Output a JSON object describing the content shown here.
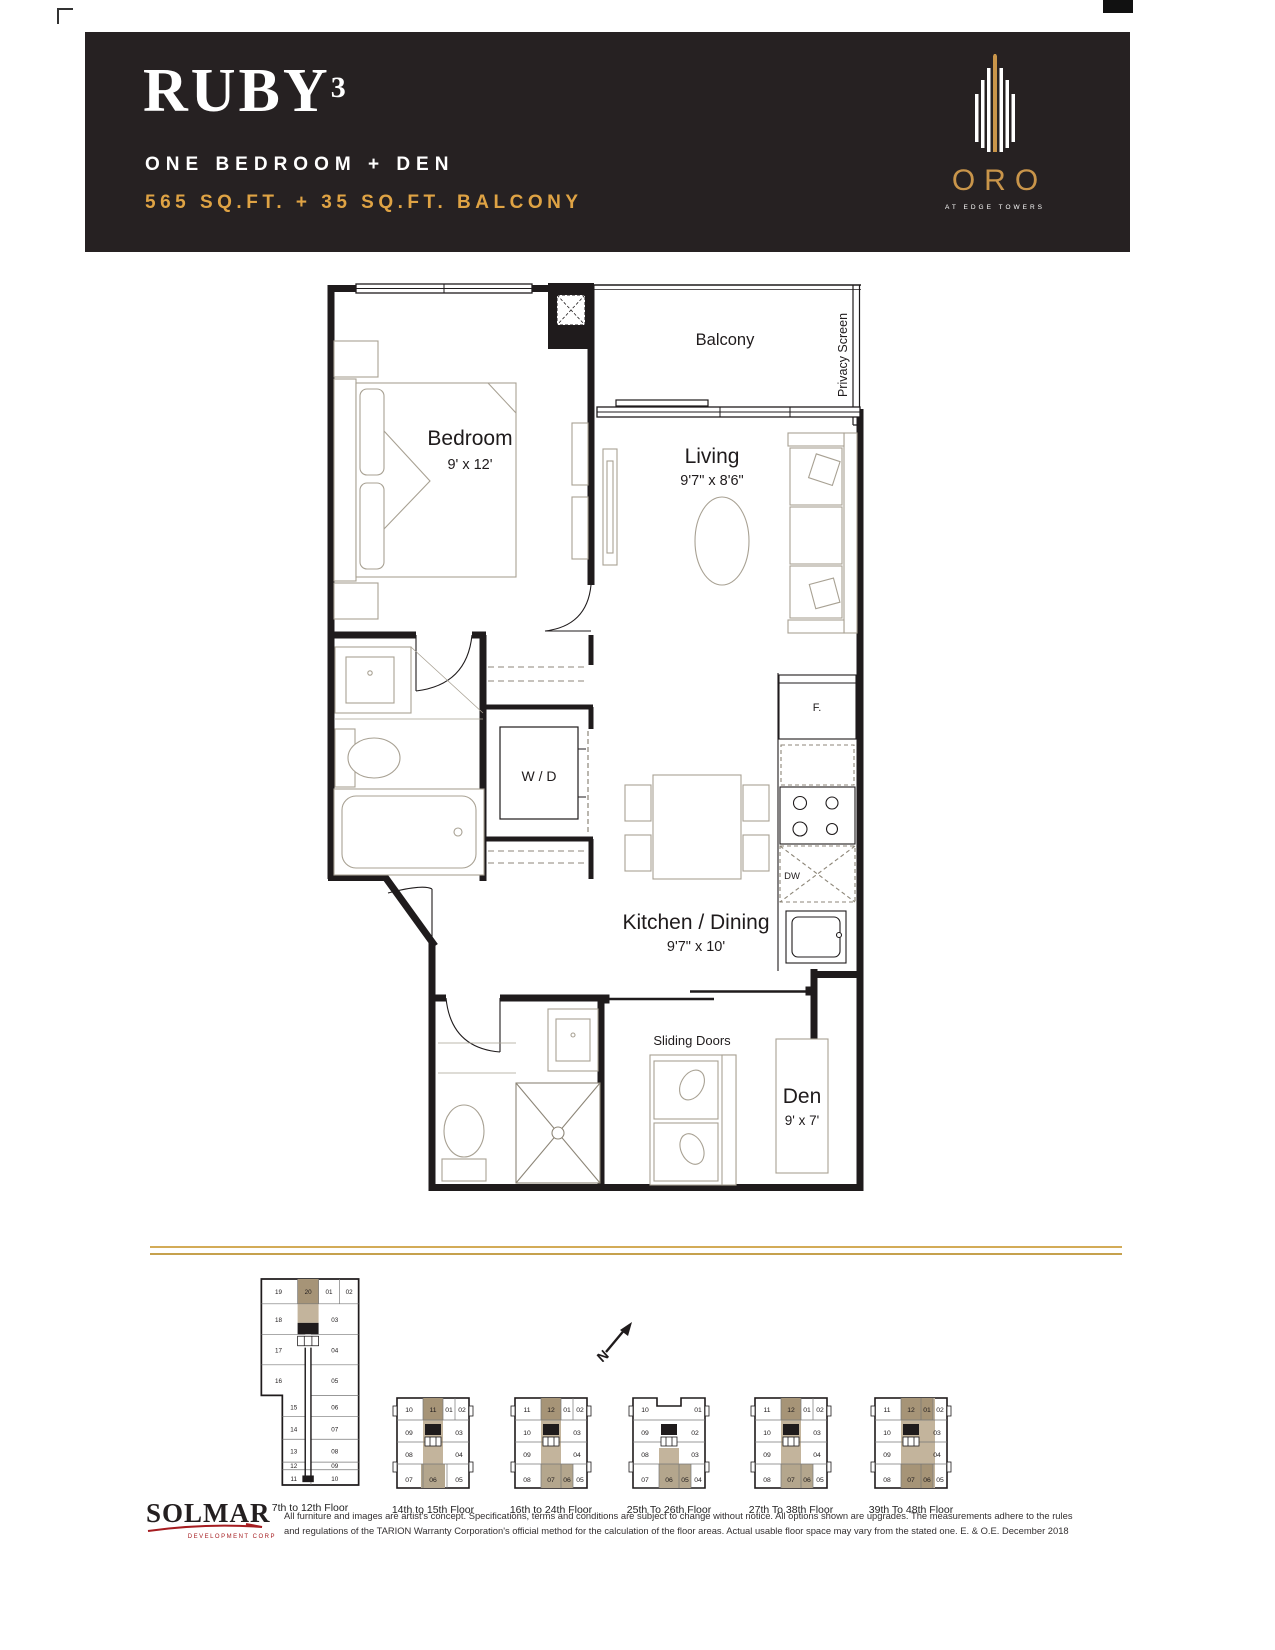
{
  "header": {
    "title": "RUBY",
    "title_sup": "3",
    "subtitle": "ONE BEDROOM + DEN",
    "area": "565 SQ.FT. + 35 SQ.FT. BALCONY",
    "brand": {
      "name": "ORO",
      "tagline": "AT EDGE TOWERS"
    },
    "colors": {
      "banner_bg": "#262122",
      "gold": "#dfa344"
    }
  },
  "floorplan": {
    "balcony": {
      "label": "Balcony"
    },
    "privacy_screen": {
      "label": "Privacy Screen"
    },
    "bedroom": {
      "name": "Bedroom",
      "dims": "9' x 12'"
    },
    "living": {
      "name": "Living",
      "dims": "9'7\" x 8'6\""
    },
    "kitchen_dining": {
      "name": "Kitchen / Dining",
      "dims": "9'7\" x 10'"
    },
    "den": {
      "name": "Den",
      "dims": "9' x 7'"
    },
    "laundry": {
      "label": "W / D"
    },
    "sliding_doors": {
      "label": "Sliding Doors"
    },
    "fridge": {
      "label": "F."
    },
    "dishwasher": {
      "label": "DW"
    }
  },
  "north_arrow": {
    "label": "N"
  },
  "keyplans": [
    {
      "label": "7th to 12th Floor",
      "top": [
        "19",
        "20",
        "01",
        "02"
      ],
      "left_upper": [
        "18",
        "17",
        "16"
      ],
      "left_lower": [
        "15",
        "14",
        "13",
        "12"
      ],
      "right_upper": [
        "03",
        "04",
        "05"
      ],
      "right_lower": [
        "06",
        "07",
        "08",
        "09"
      ],
      "bottom": [
        "11",
        "10"
      ]
    },
    {
      "label": "14th to 15th Floor",
      "top": [
        "10",
        "11",
        "01",
        "02"
      ],
      "left": [
        "09",
        "08"
      ],
      "right": [
        "03",
        "04"
      ],
      "bottom": [
        "07",
        "06",
        "05"
      ]
    },
    {
      "label": "16th to 24th Floor",
      "top": [
        "11",
        "12",
        "01",
        "02"
      ],
      "left": [
        "10",
        "09"
      ],
      "right": [
        "03",
        "04"
      ],
      "bottom": [
        "08",
        "07",
        "06",
        "05"
      ]
    },
    {
      "label": "25th To 26th Floor",
      "top": [
        "10",
        "01"
      ],
      "left": [
        "09",
        "08"
      ],
      "right": [
        "02",
        "03"
      ],
      "bottom": [
        "07",
        "06",
        "05",
        "04"
      ]
    },
    {
      "label": "27th To 38th Floor",
      "top": [
        "11",
        "12",
        "01",
        "02"
      ],
      "left": [
        "10",
        "09"
      ],
      "right": [
        "03",
        "04"
      ],
      "bottom": [
        "08",
        "07",
        "06",
        "05"
      ]
    },
    {
      "label": "39th To 48th Floor",
      "top": [
        "11",
        "12",
        "01",
        "02"
      ],
      "left": [
        "10",
        "09"
      ],
      "right": [
        "03",
        "04"
      ],
      "bottom": [
        "08",
        "07",
        "06",
        "05"
      ]
    }
  ],
  "footer": {
    "logo": {
      "name": "SOLMAR",
      "sub": "DEVELOPMENT CORP"
    },
    "disclaimer_line1": "All furniture and images are artist's concept. Specifications, terms and conditions are subject to change without notice. All options shown are upgrades. The measurements adhere to the rules",
    "disclaimer_line2": "and regulations of the TARION Warranty Corporation's official method for the calculation of the floor areas. Actual usable floor space may vary from the stated one. E. & O.E. December 2018"
  },
  "colors": {
    "tan_light": "#c3b49c",
    "tan_dark": "#a69477",
    "tan_mid": "#b4a68d",
    "gold_rule": "#d3ab57",
    "red": "#a51c20"
  }
}
